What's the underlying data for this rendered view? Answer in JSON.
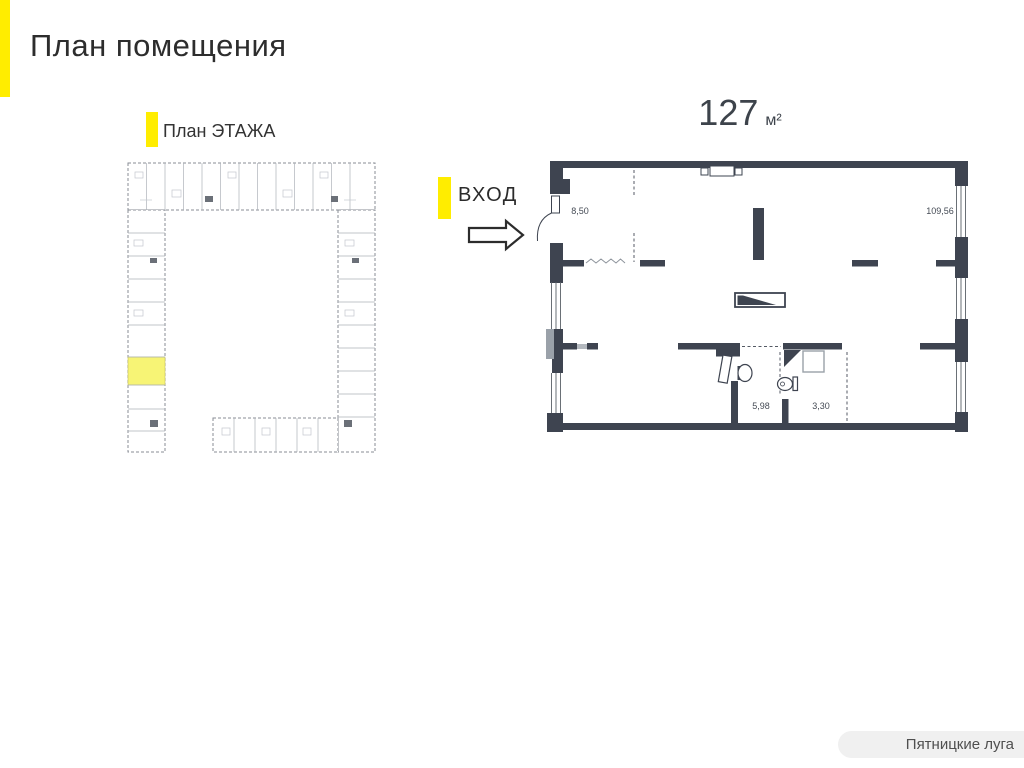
{
  "header": {
    "title": "План помещения"
  },
  "floor_overview": {
    "label": "План ЭТАЖА"
  },
  "entrance": {
    "label": "ВХОД"
  },
  "unit": {
    "area": "127",
    "area_unit": "м²",
    "rooms": {
      "r1": "8,50",
      "r2": "109,56",
      "r3": "5,98",
      "r4": "3,30"
    }
  },
  "footer": {
    "brand": "Пятницкие луга"
  },
  "colors": {
    "accent_yellow": "#ffed00",
    "highlight_yellow": "#f7f475",
    "wall": "#3e4450",
    "plan_gray": "#9aa1a9"
  }
}
